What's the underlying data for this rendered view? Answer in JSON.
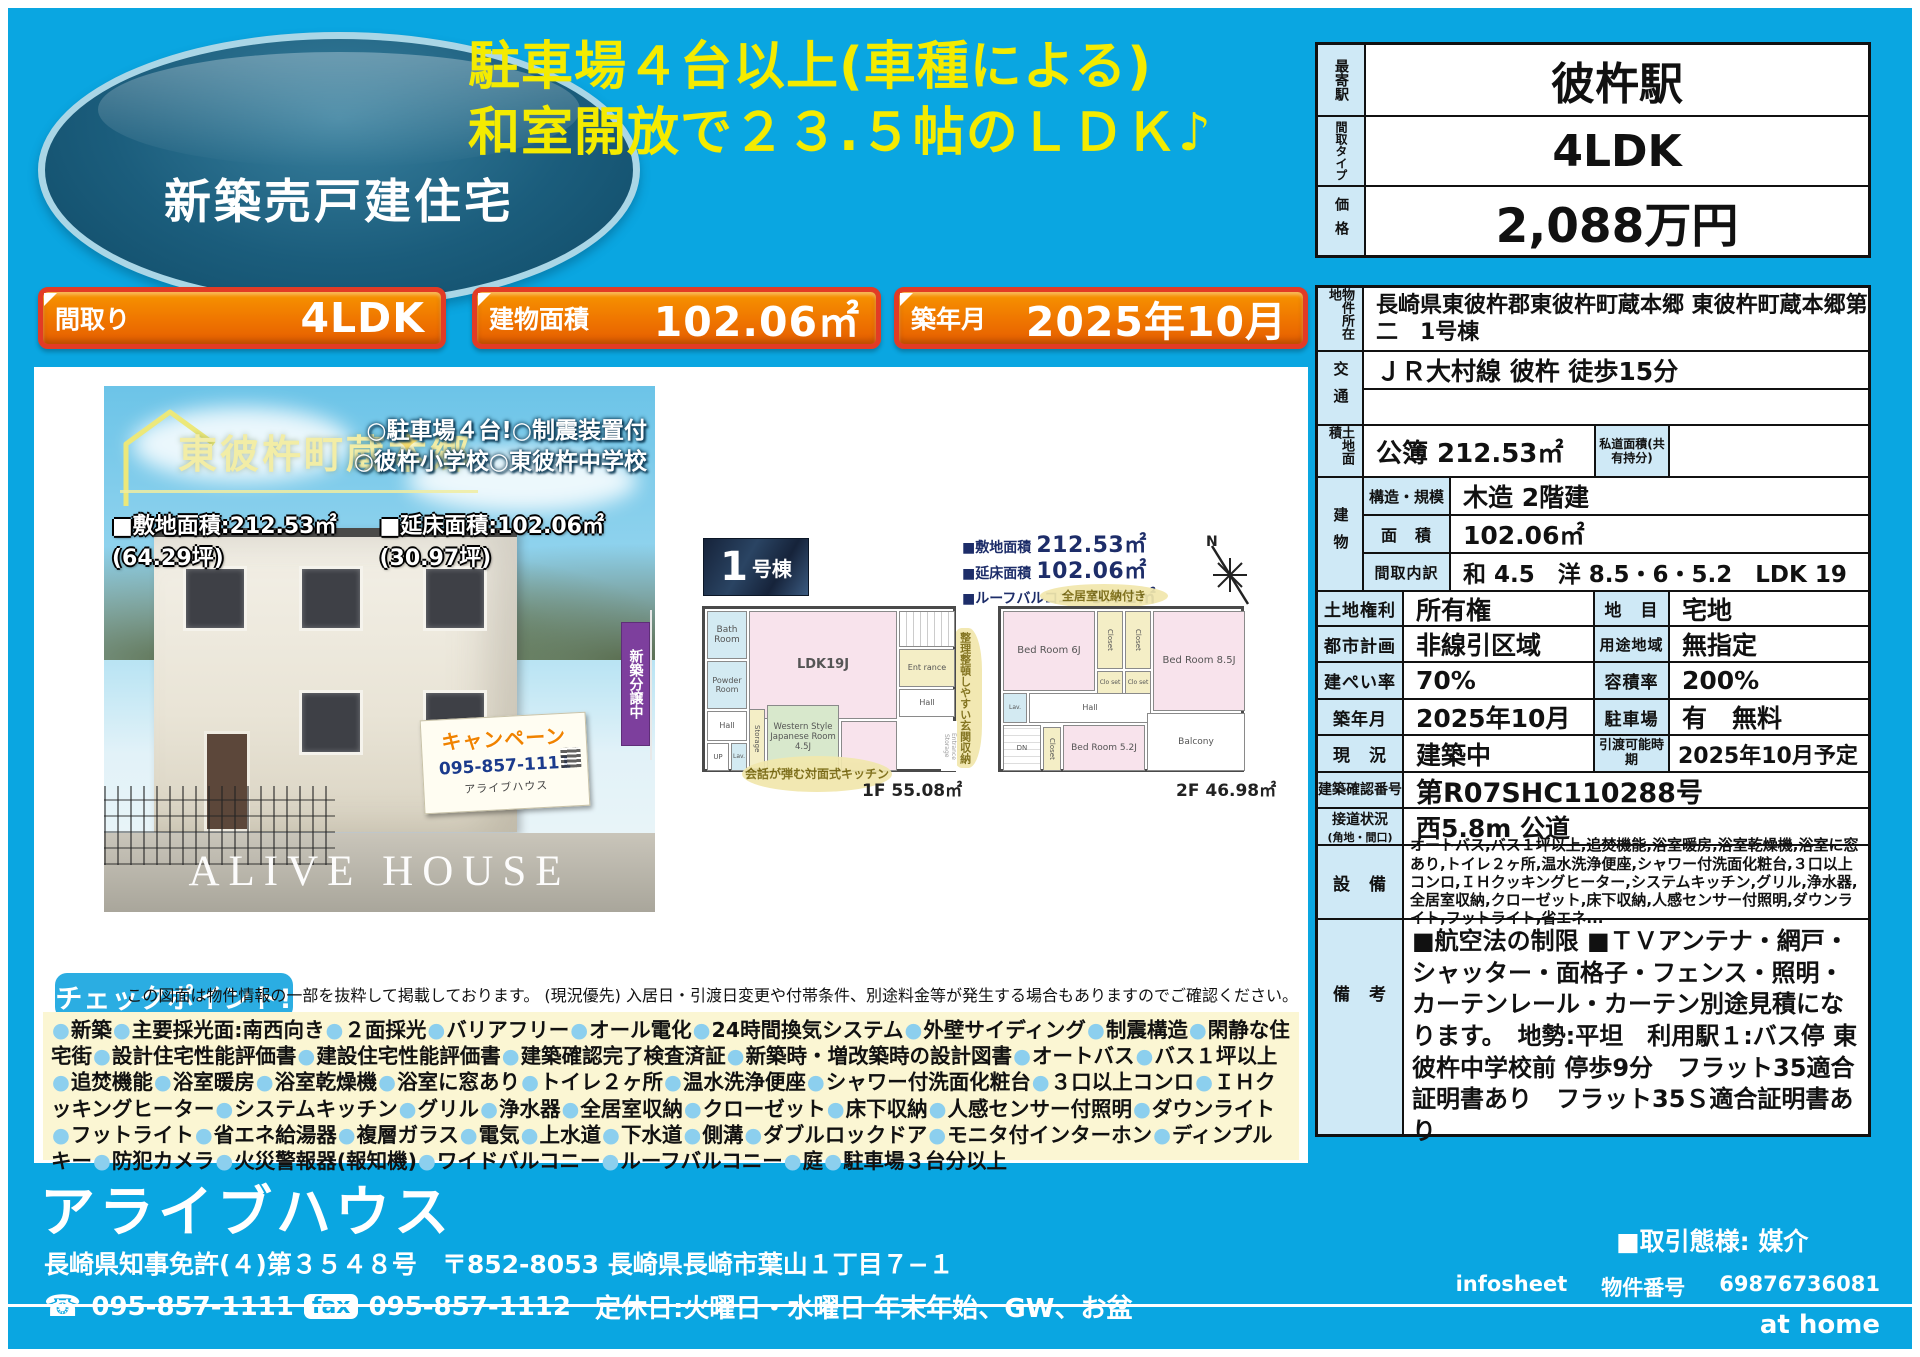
{
  "oval_badge": {
    "label": "新築売戸建住宅"
  },
  "headline": {
    "line1": "駐車場４台以上(車種による)",
    "line2": "和室開放で２３.５帖のＬＤＫ♪"
  },
  "summary_table": {
    "station_label": "最寄駅",
    "station": "彼杵駅",
    "layout_label": "間取タイプ",
    "layout": "4LDK",
    "price_label": "価格",
    "price": "2,088万円"
  },
  "badges": [
    {
      "label": "間取り",
      "value": "4LDK"
    },
    {
      "label": "建物面積",
      "value": "102.06㎡"
    },
    {
      "label": "築年月",
      "value": "2025年10月"
    }
  ],
  "photo": {
    "location_name": "東彼杵町蔵本郷",
    "point_line1": "○駐車場４台!○制震装置付",
    "point_line2": "○彼杵小学校○東彼杵中学校",
    "site_area": "■敷地面積:212.53㎡(64.29坪)",
    "floor_area": "■延床面積:102.06㎡(30.97坪)",
    "flag": "新築分譲中",
    "campaign": {
      "title": "キャンペーン",
      "phone": "095-857-1111",
      "company": "アライブハウス"
    },
    "watermark": "ALIVE HOUSE"
  },
  "floorplan": {
    "unit_number": "1",
    "unit_suffix": "号棟",
    "area1_label": "■敷地面積",
    "area1_value": "212.53㎡",
    "area2_label": "■延床面積",
    "area2_value": "102.06㎡",
    "area3_label": "■ルーフバルコニー",
    "area3_value": "9.72㎡",
    "compass": "N",
    "note_kitchen": "会話が弾む対面式キッチン",
    "note_entrance": "整理整頓しやすい玄関収納",
    "note_storage": "全居室収納付き",
    "f1_label": "1F 55.08㎡",
    "f2_label": "2F 46.98㎡",
    "f1": {
      "bath": "Bath Room",
      "powder": "Powder Room",
      "ldk": "LDK19J",
      "jroom": "Western Style Japanese Room 4.5J",
      "storage": "Storage",
      "hall": "Hall",
      "up": "UP",
      "lav": "Lav.",
      "entrance": "Ent rance",
      "hall2": "Hall",
      "ent_storage": "Entrance Storage"
    },
    "f2": {
      "bed6": "Bed Room 6J",
      "bed85": "Bed Room 8.5J",
      "bed52": "Bed Room 5.2J",
      "closet1": "Closet",
      "closet2": "Closet",
      "closet3": "Clo set",
      "closet4": "Clo set",
      "closet5": "Closet",
      "hall": "Hall",
      "lav": "Lav.",
      "dn": "DN",
      "balcony": "Balcony"
    }
  },
  "info_table": {
    "location": {
      "label": "物件所在地",
      "value": "長崎県東彼杵郡東彼杵町蔵本郷 東彼杵町蔵本郷第二　1号棟"
    },
    "transport": {
      "label": "交通",
      "value": "ＪＲ大村線 彼杵 徒歩15分",
      "value2": ""
    },
    "land_area": {
      "label": "土地面積",
      "value": "公簿 212.53㎡",
      "sub_label": "私道面積(共有持分)",
      "sub_value": ""
    },
    "building": {
      "label": "建物",
      "structure_label": "構造・規模",
      "structure": "木造 2階建",
      "area_label": "面　積",
      "area": "102.06㎡",
      "layout_label": "間取内訳",
      "layout": "和 4.5　洋 8.5・6・5.2　LDK 19"
    },
    "land_rights": {
      "label": "土地権利",
      "value": "所有権",
      "label2": "地　目",
      "value2": "宅地"
    },
    "city_plan": {
      "label": "都市計画",
      "value": "非線引区域",
      "label2": "用途地域",
      "value2": "無指定"
    },
    "coverage": {
      "label": "建ぺい率",
      "value": "70%",
      "label2": "容積率",
      "value2": "200%"
    },
    "built": {
      "label": "築年月",
      "value": "2025年10月",
      "label2": "駐車場",
      "value2": "有　無料"
    },
    "status": {
      "label": "現　況",
      "value": "建築中",
      "label2": "引渡可能時期",
      "value2": "2025年10月予定"
    },
    "confirmation": {
      "label": "建築確認番号",
      "value": "第R07SHC110288号"
    },
    "road": {
      "label": "接道状況",
      "label_sub": "(角地・間口)",
      "value": "西5.8m 公道"
    },
    "equipment": {
      "label": "設　備",
      "value": "オートバス,バス１坪以上,追焚機能,浴室暖房,浴室乾燥機,浴室に窓あり,トイレ２ヶ所,温水洗浄便座,シャワー付洗面化粧台,３口以上コンロ,ＩＨクッキングヒーター,システムキッチン,グリル,浄水器,全居室収納,クローゼット,床下収納,人感センサー付照明,ダウンライト,フットライト,省エネ..."
    },
    "remarks": {
      "label": "備　考",
      "value": "■航空法の制限 ■ＴＶアンテナ・網戸・シャッター・面格子・フェンス・照明・カーテンレール・カーテン別途見積になります。　地勢:平坦　利用駅１:バス停 東彼杵中学校前 停歩9分　フラット35適合証明書あり　フラット35Ｓ適合証明書あり"
    }
  },
  "checkpoint": {
    "badge": "チェックポイント!",
    "disclaimer": "この図面は物件情報の一部を抜粋して掲載しております。 (現況優先) 入居日・引渡日変更や付帯条件、別途料金等が発生する場合もありますのでご確認ください。",
    "features": [
      "新築",
      "主要採光面:南西向き",
      "２面採光",
      "バリアフリー",
      "オール電化",
      "24時間換気システム",
      "外壁サイディング",
      "制震構造",
      "閑静な住宅街",
      "設計住宅性能評価書",
      "建設住宅性能評価書",
      "建築確認完了検査済証",
      "新築時・増改築時の設計図書",
      "オートバス",
      "バス１坪以上",
      "追焚機能",
      "浴室暖房",
      "浴室乾燥機",
      "浴室に窓あり",
      "トイレ２ヶ所",
      "温水洗浄便座",
      "シャワー付洗面化粧台",
      "３口以上コンロ",
      "ＩＨクッキングヒーター",
      "システムキッチン",
      "グリル",
      "浄水器",
      "全居室収納",
      "クローゼット",
      "床下収納",
      "人感センサー付照明",
      "ダウンライト",
      "フットライト",
      "省エネ給湯器",
      "複層ガラス",
      "電気",
      "上水道",
      "下水道",
      "側溝",
      "ダブルロックドア",
      "モニタ付インターホン",
      "ディンプルキー",
      "防犯カメラ",
      "火災警報器(報知機)",
      "ワイドバルコニー",
      "ルーフバルコニー",
      "庭",
      "駐車場３台分以上"
    ]
  },
  "footer": {
    "company": "アライブハウス",
    "license": "長崎県知事免許(４)第３５４８号　〒852-8053 長崎県長崎市葉山１丁目７−１",
    "tel": "095-857-1111",
    "fax_label": "fax",
    "fax": "095-857-1112",
    "holiday": "定休日:火曜日・水曜日 年末年始、GW、お盆",
    "deal": "■取引態様: 媒介",
    "infosheet": "infosheet",
    "bukken_label": "物件番号",
    "bukken_number": "69876736081",
    "logo": "at home"
  }
}
